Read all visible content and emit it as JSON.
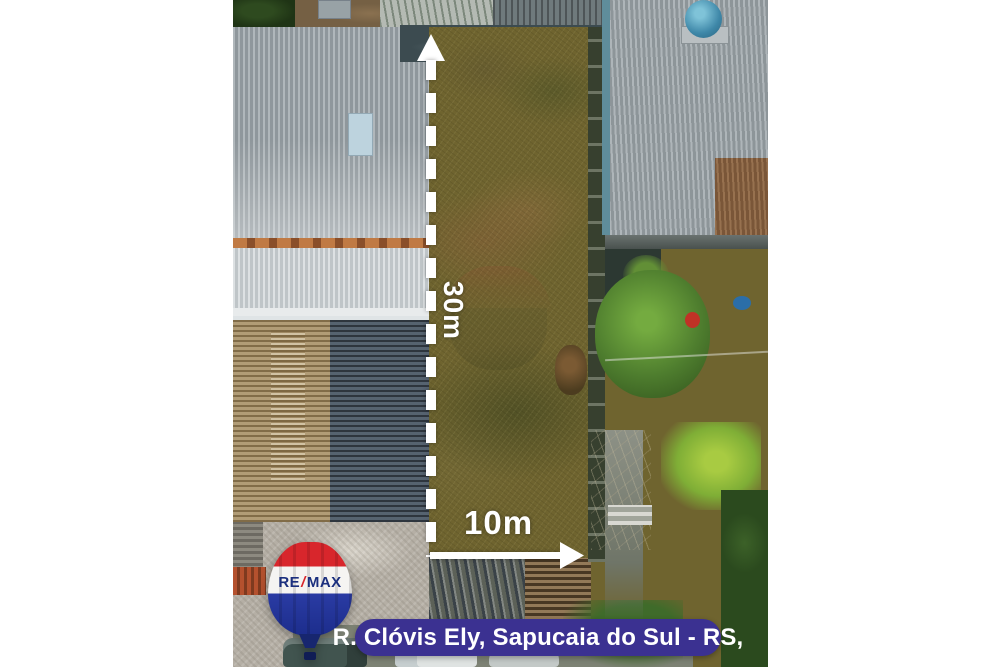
{
  "image": {
    "type": "aerial-property-photo",
    "caption": "R. Clóvis Ely, Sapucaia do Sul - RS,",
    "dimensions": {
      "vertical_label": "30m",
      "horizontal_label": "10m"
    },
    "logo": {
      "brand_re": "RE",
      "brand_slash": "/",
      "brand_max": "MAX"
    },
    "colors": {
      "caption_bg": "#3b3191",
      "annotation_white": "#ffffff",
      "balloon_red": "#d8262c",
      "balloon_blue": "#1c2d8c",
      "logo_text_blue": "#1b2f7e",
      "page_margin": "#ffffff"
    }
  }
}
